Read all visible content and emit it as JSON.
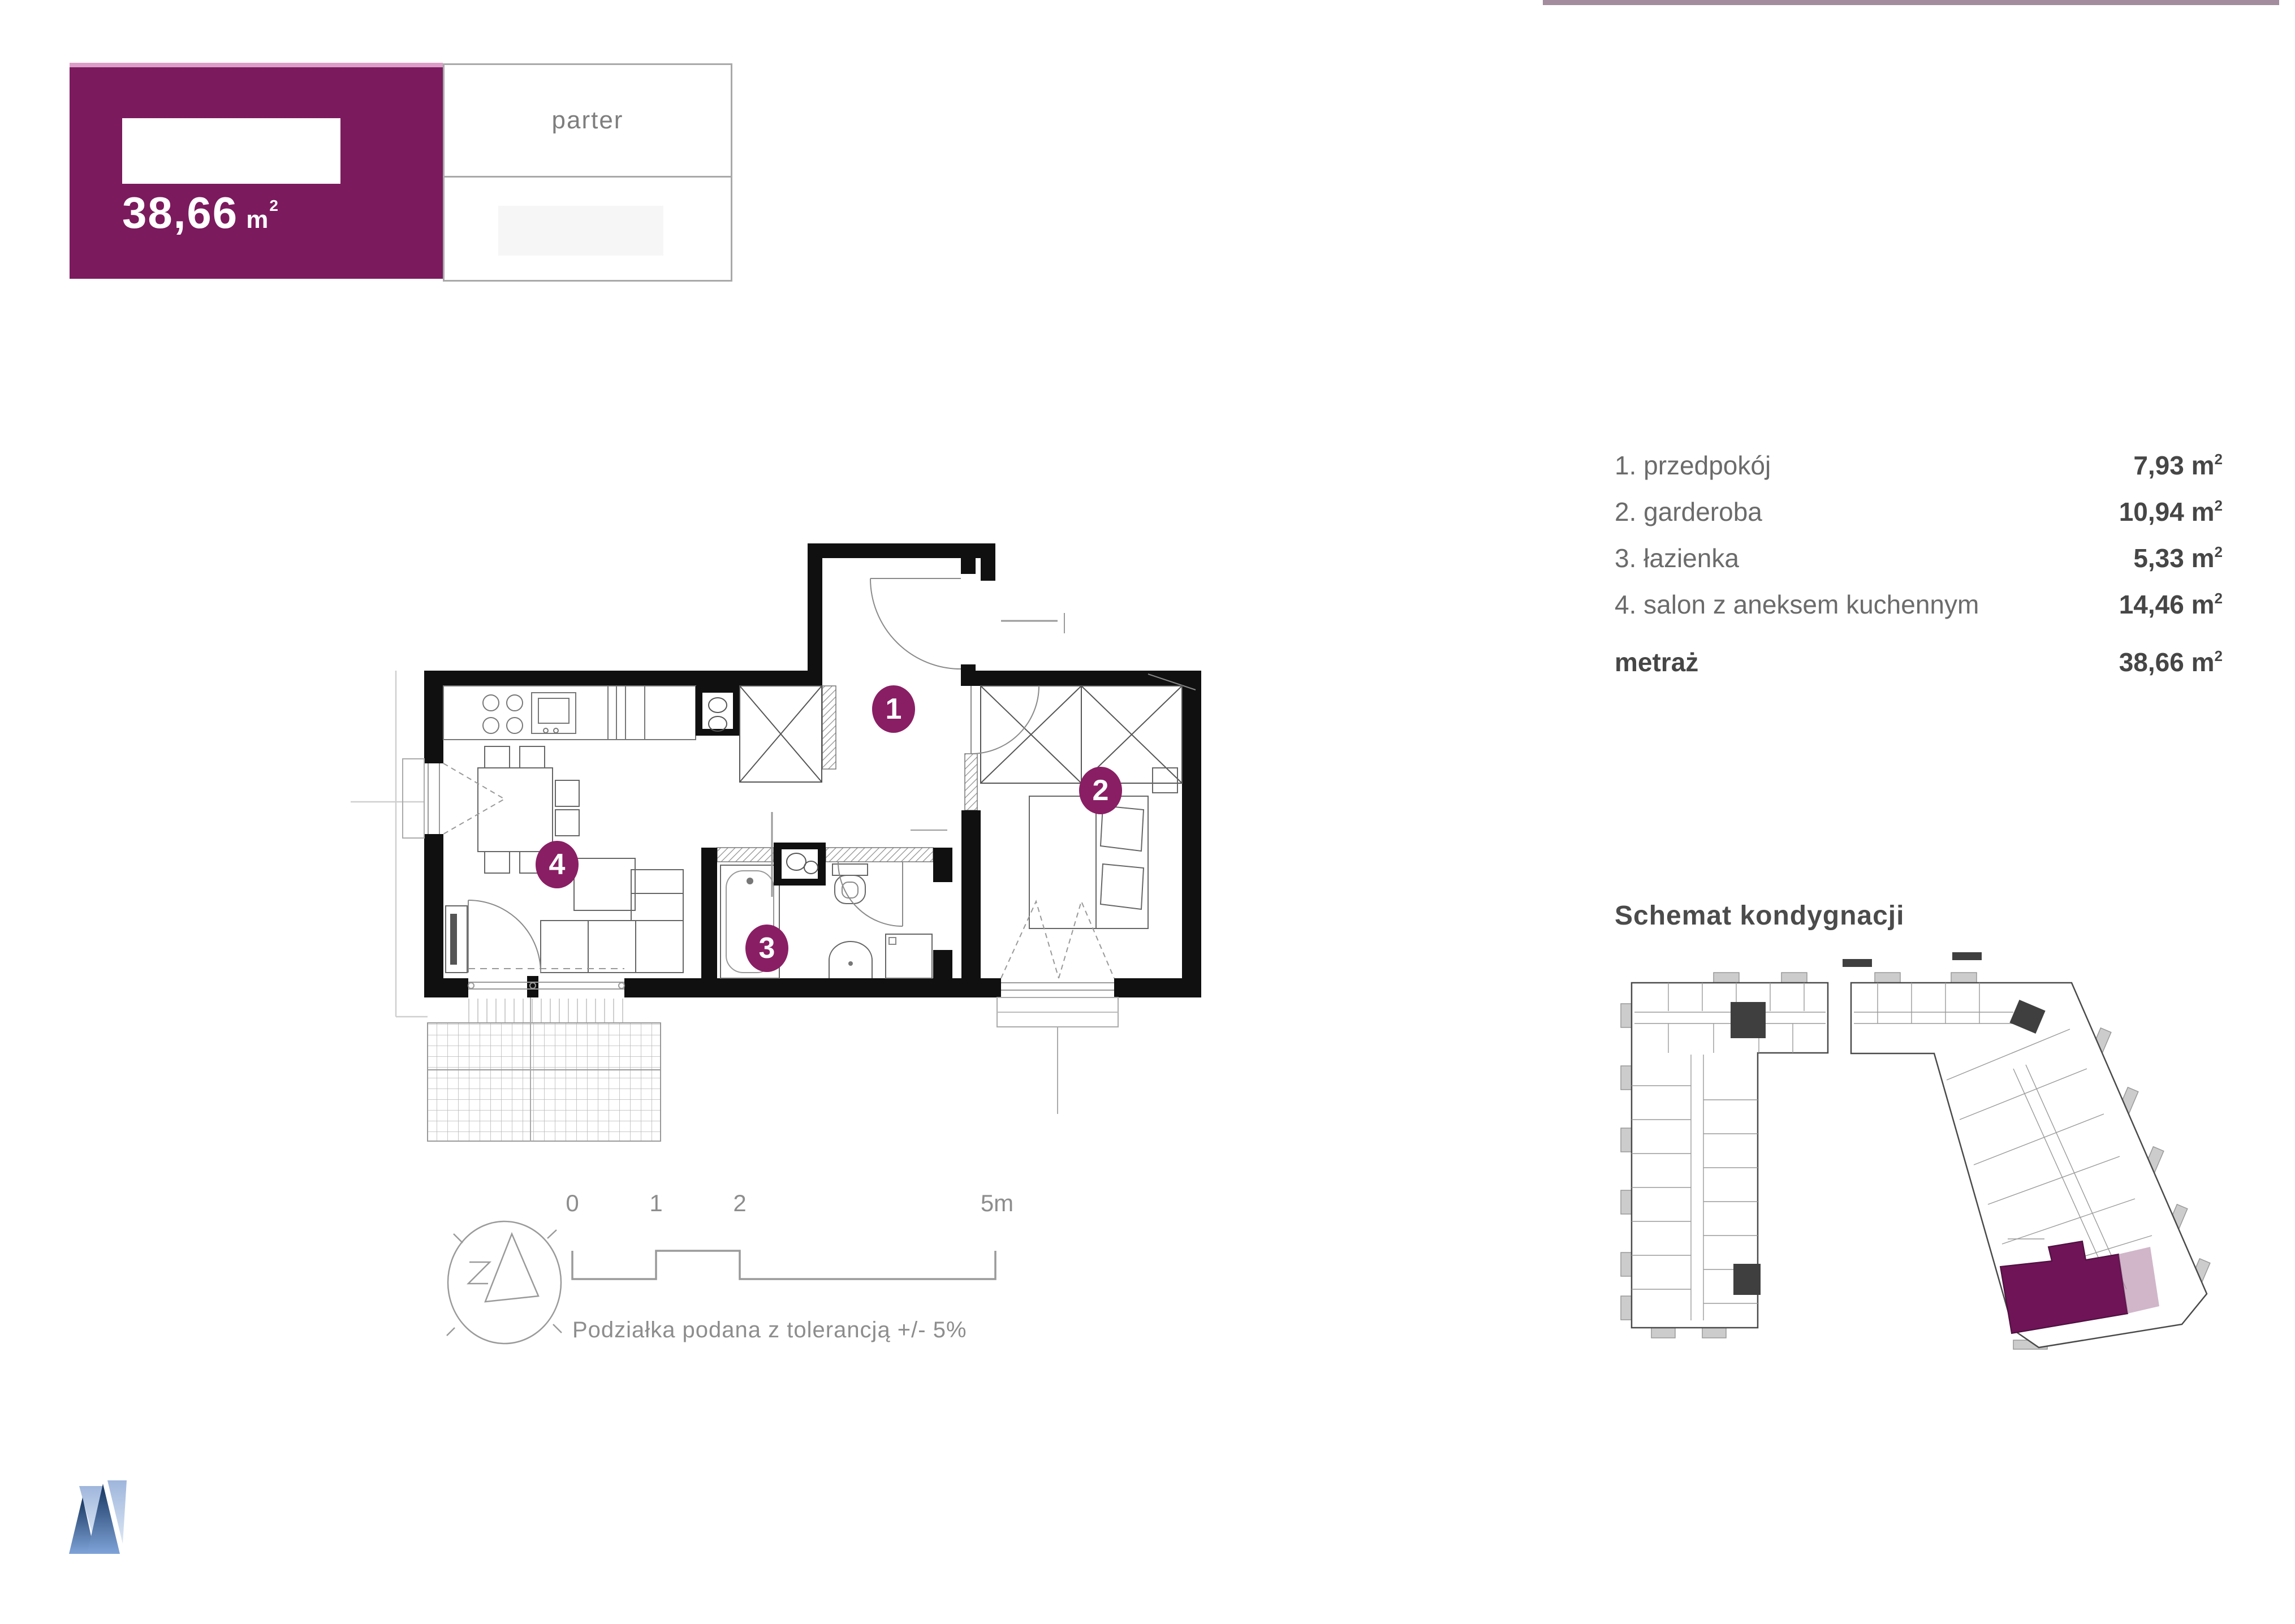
{
  "header": {
    "area_value": "38,66",
    "area_unit": "m",
    "area_sup": "2",
    "floor_label": "parter",
    "accent_color": "#7c1a5e",
    "accent_line_color": "#dc9ec9",
    "top_strip_color": "#a28c9d"
  },
  "rooms": {
    "items": [
      {
        "label": "1. przedpokój",
        "value": "7,93",
        "unit": "m",
        "sup": "2"
      },
      {
        "label": "2. garderoba",
        "value": "10,94",
        "unit": "m",
        "sup": "2"
      },
      {
        "label": "3. łazienka",
        "value": "5,33",
        "unit": "m",
        "sup": "2"
      },
      {
        "label": "4. salon z aneksem kuchennym",
        "value": "14,46",
        "unit": "m",
        "sup": "2"
      }
    ],
    "total": {
      "label": "metraż",
      "value": "38,66",
      "unit": "m",
      "sup": "2"
    }
  },
  "plan": {
    "badges": [
      "1",
      "2",
      "3",
      "4"
    ],
    "badge_color": "#8a1e64",
    "wall_color": "#101010"
  },
  "schematic": {
    "title": "Schemat kondygnacji",
    "highlight_color": "#6e1457"
  },
  "scalebar": {
    "ticks": [
      "0",
      "1",
      "2",
      "5m"
    ],
    "caption": "Podziałka podana z tolerancją +/- 5%"
  },
  "logo": {
    "dark_color": "#27477a",
    "light_color": "#a9c0e2"
  }
}
